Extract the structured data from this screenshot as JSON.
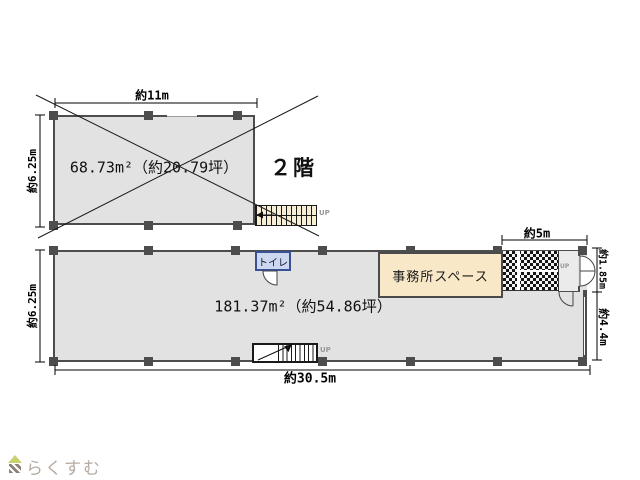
{
  "floor2": {
    "area_label": "68.73m²（約20.79坪）",
    "name_label": "２階",
    "width_dim": "約11m",
    "height_dim": "約6.25m",
    "stairs_up_label": "UP"
  },
  "floor1": {
    "area_label": "181.37m²（約54.86坪）",
    "toilet_label": "トイレ",
    "office_label": "事務所スペース",
    "height_dim": "約6.25m",
    "width_dim": "約30.5m",
    "entrance_width_dim": "約5m",
    "right_top_dim": "約1.85m",
    "right_bottom_dim": "約4.4m",
    "stairs_up_label": "UP",
    "entrance_up_label": "UP"
  },
  "branding": {
    "logo_text": "らくすむ"
  },
  "colors": {
    "floor_fill": "#e2e2e2",
    "wall": "#4d4d4d",
    "stairs_fill": "#f6efd6",
    "office_fill": "#f8e8c7",
    "toilet_fill": "#ccd7f0",
    "toilet_border": "#3a5096",
    "up_text": "#999999",
    "logo_text_color": "#b5aba1",
    "logo_roof": "#c9d26e",
    "logo_body": "#8a8078"
  }
}
